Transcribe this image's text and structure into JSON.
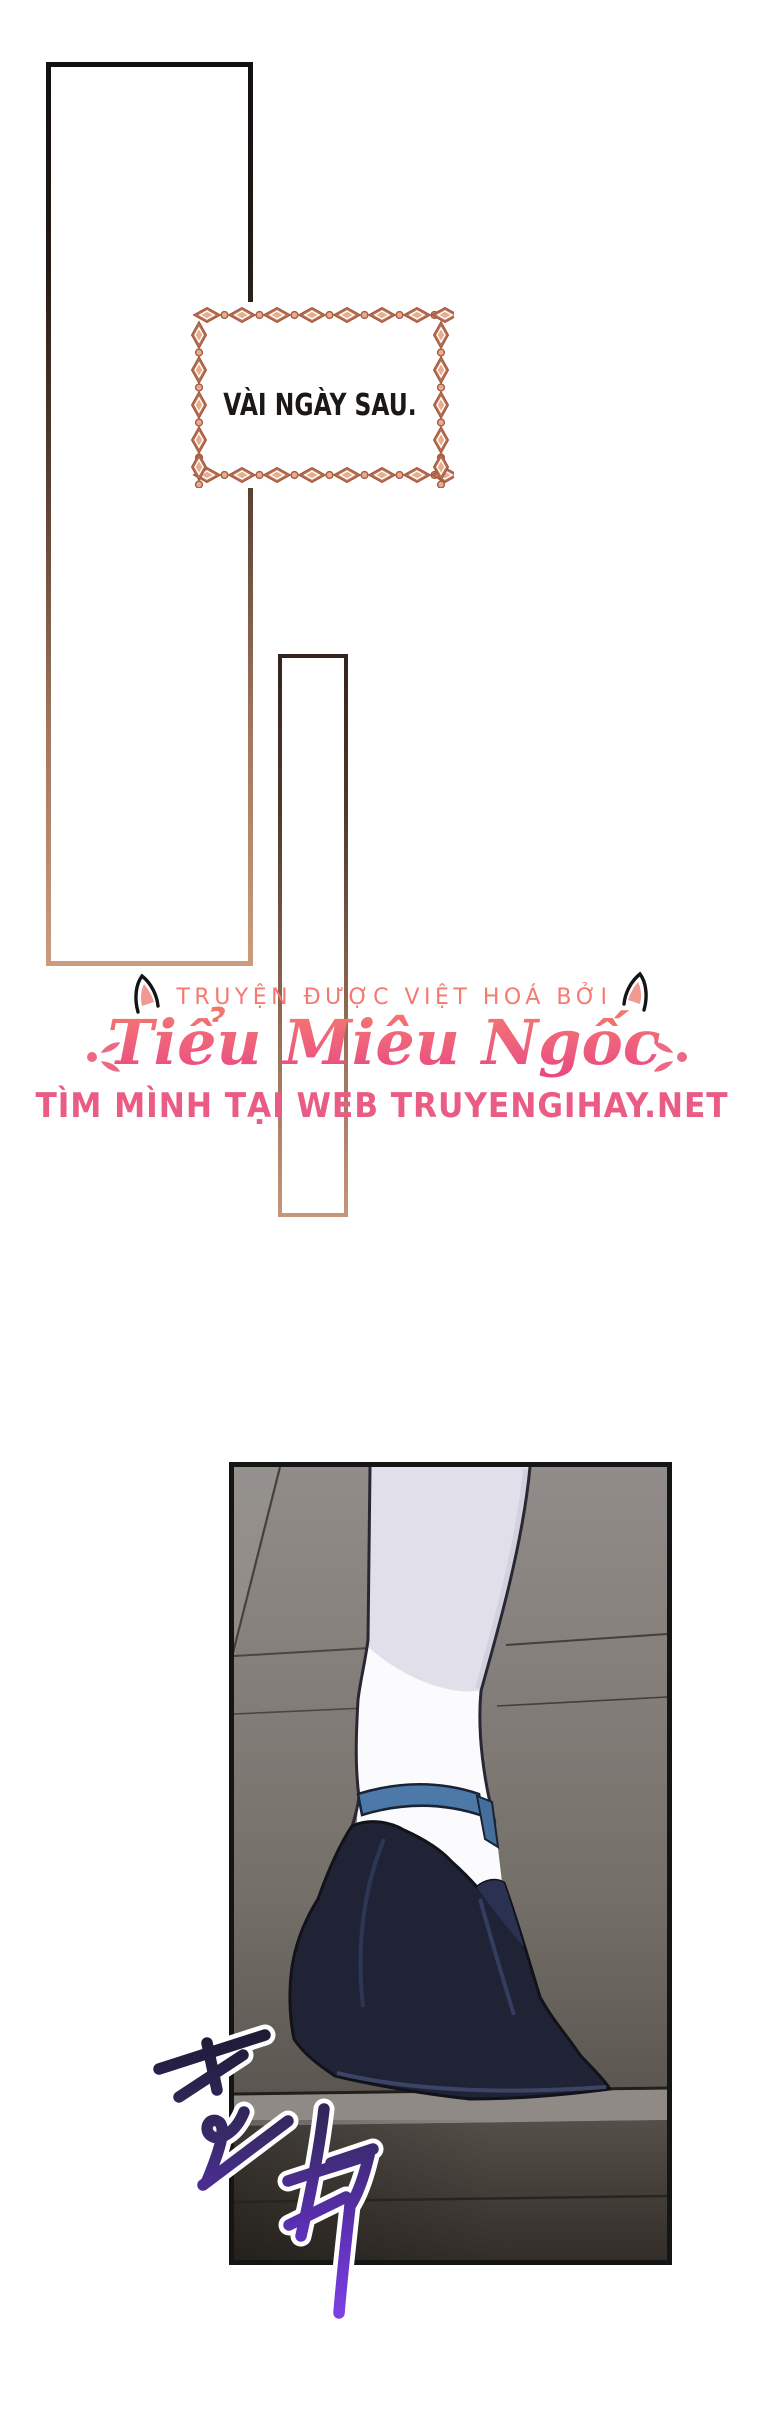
{
  "page": {
    "width": 760,
    "height": 2419,
    "background": "#ffffff"
  },
  "caption_box": {
    "text": "VÀI NGÀY SAU.",
    "text_color": "#1b1816",
    "border_style": "knot-chain",
    "border_fill": "#e8ac8f",
    "border_line": "#a65c40"
  },
  "frames": {
    "big_rect_gradient_top": "#131010",
    "big_rect_gradient_bottom": "#cb9b7f",
    "small_rect_gradient_top": "#33251d",
    "small_rect_gradient_bottom": "#c59579"
  },
  "credits": {
    "line1": "TRUYỆN ĐƯỢC VIỆT HOÁ BỞI",
    "title": "Tiểu Miêu Ngốc",
    "line3": "TÌM MÌNH TẠI WEB TRUYENGIHAY.NET",
    "line1_color": "#f5796f",
    "title_gradient_top": "#f4776e",
    "title_gradient_bottom": "#e8457e",
    "line3_color": "#ea5c84",
    "cat_ear_inner_color": "#f29a92",
    "cat_ear_outline_color": "#141414",
    "flourish_color": "#ee6a84"
  },
  "panel": {
    "sfx_text": "또각",
    "sfx_gradient_top": "#1e1b36",
    "sfx_gradient_bottom": "#7d3fe2",
    "sfx_outline": "#ffffff",
    "wall_color": "#847e7a",
    "sock_color": "#fbfbfd",
    "strap_color": "#4d79a8",
    "shoe_color": "#1f2335",
    "step_top_color": "#8f8a85",
    "step_face_color": "#3b362f",
    "border_color": "#151515"
  }
}
